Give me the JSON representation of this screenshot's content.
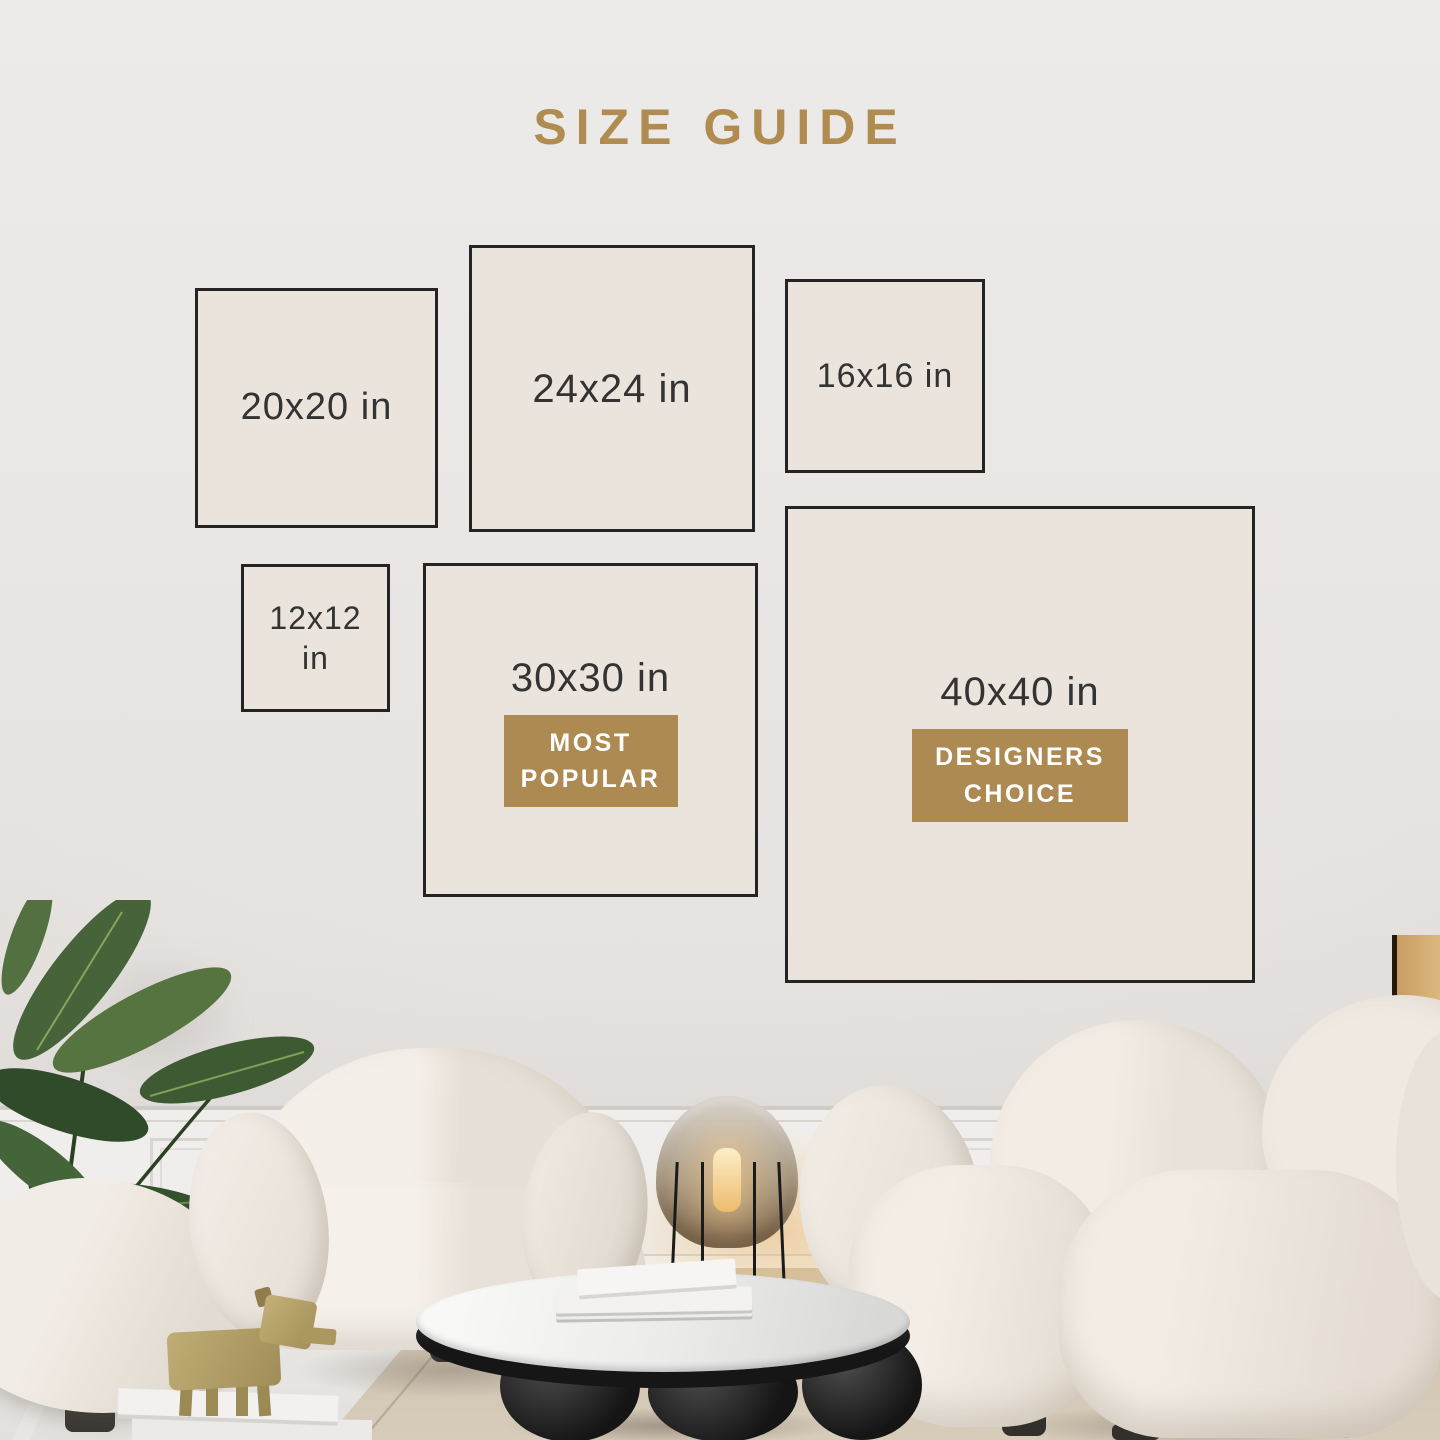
{
  "page_title": "SIZE GUIDE",
  "size_guide": {
    "title": "SIZE GUIDE",
    "boxes": [
      {
        "id": "20x20",
        "label": "20x20 in"
      },
      {
        "id": "24x24",
        "label": "24x24 in"
      },
      {
        "id": "16x16",
        "label": "16x16 in"
      },
      {
        "id": "12x12",
        "label": "12x12 in"
      },
      {
        "id": "30x30",
        "label": "30x30 in",
        "badge": "MOST POPULAR"
      },
      {
        "id": "40x40",
        "label": "40x40 in",
        "badge": "DESIGNERS CHOICE"
      }
    ]
  },
  "colors": {
    "accent_gold": "#b08c50",
    "badge_gold": "#ad8a51",
    "frame_border": "#242424",
    "frame_fill": "#eae4dc",
    "label_text": "#333333",
    "badge_text": "#ffffff"
  },
  "scene": {
    "objects": [
      "potted-plant",
      "cream-armchair",
      "cream-sofa",
      "cream-ottoman",
      "smoked-glass-floor-lamp",
      "round-marble-coffee-table",
      "stacked-books",
      "brass-dog-figurine",
      "beige-area-rug",
      "wainscoting-wall"
    ]
  }
}
